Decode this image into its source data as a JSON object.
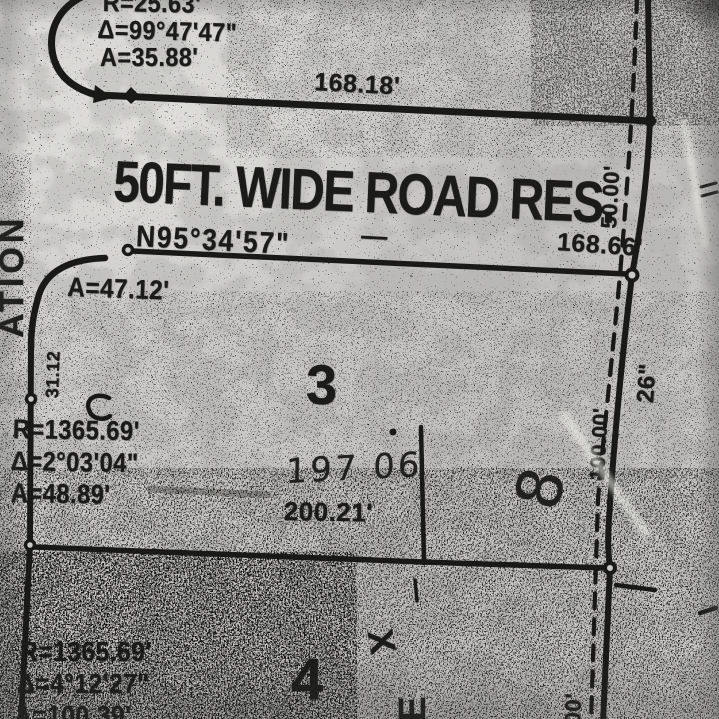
{
  "colors": {
    "ink": "#1a1a18",
    "paper": "#cac9c7"
  },
  "road": {
    "label": "50FT. WIDE ROAD RES.",
    "width_dim": "50.00'"
  },
  "bearing_line": {
    "bearing": "N95°34'57\"",
    "separator": "—",
    "distance": "168.66'"
  },
  "top_lot": {
    "frontage": "168.18'",
    "curve": {
      "r": "R=25.63'",
      "delta": "Δ=99°47'47\"",
      "arc": "A=35.88'"
    }
  },
  "lot3": {
    "number": "3",
    "corner_arc": "A=47.12'",
    "side_dim": "31.12",
    "curve": {
      "r": "R=1365.69'",
      "delta": "Δ=2°03'04\"",
      "arc": "A=48.89'"
    },
    "handwritten_area": "197 06",
    "frontage": "200.21'"
  },
  "lot4": {
    "number": "4",
    "curve": {
      "r": "R=1365.69'",
      "delta": "Δ=4°12'27\"",
      "arc": "A=100.39'"
    }
  },
  "right_side": {
    "depth_dim": "100.00'",
    "width_note": "26\"",
    "handwritten_lot": "8",
    "partial_dim": "00'"
  },
  "edge_text": {
    "left_vertical": "ATION"
  },
  "handwritten_marks": {
    "x": "X",
    "e": "E"
  }
}
